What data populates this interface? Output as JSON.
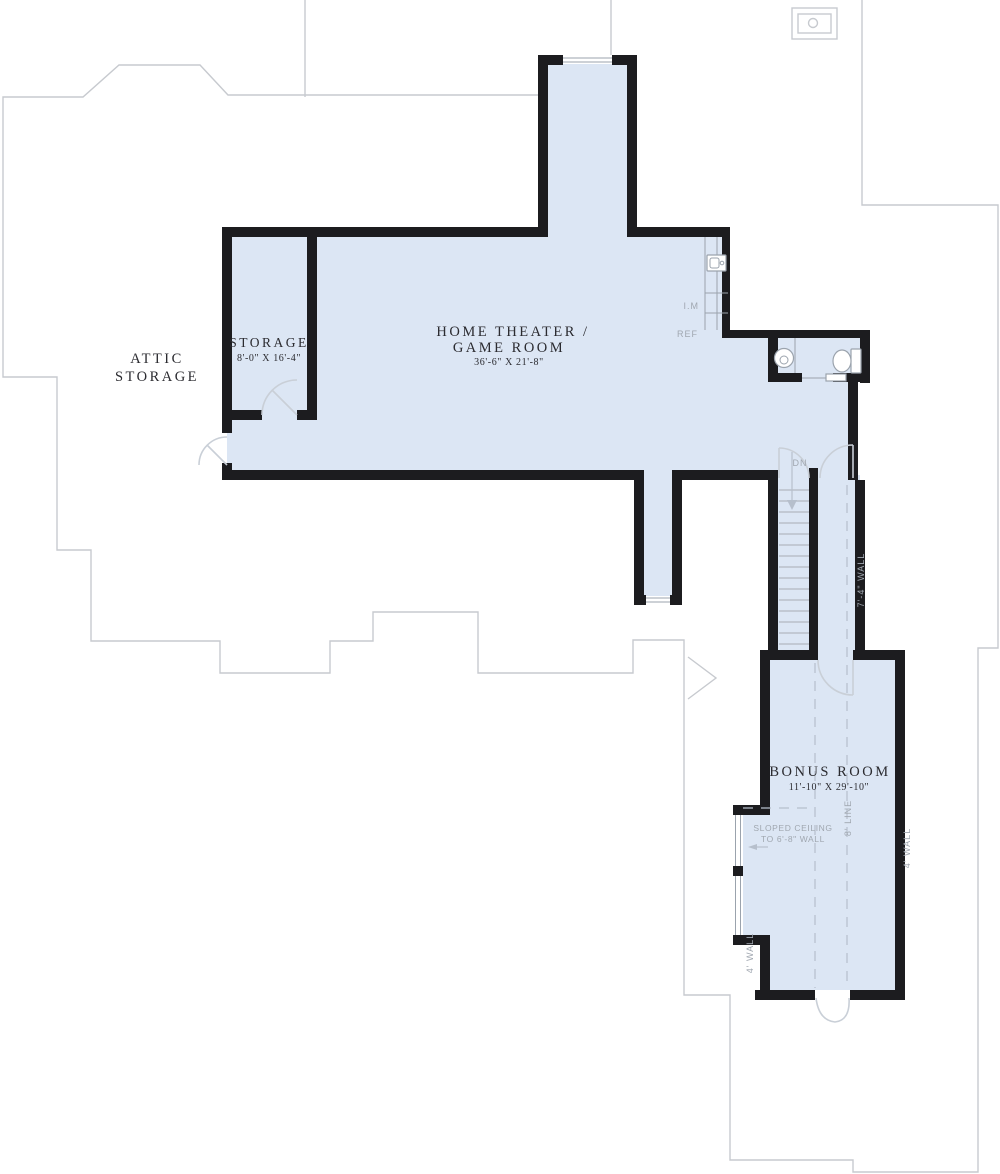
{
  "plan_type": "second-floor house plan",
  "colors": {
    "room_fill": "#dce6f4",
    "wall": "#1c1c1f",
    "roofline": "#c7cacf",
    "annotation": "#a0a7b0",
    "label": "#2b2b30"
  },
  "rooms": {
    "attic": {
      "line1": "ATTIC",
      "line2": "STORAGE"
    },
    "storage": {
      "name": "STORAGE",
      "dims": "8'-0\" X 16'-4\""
    },
    "theater": {
      "line1": "HOME THEATER /",
      "line2": "GAME ROOM",
      "dims": "36'-6\" X 21'-8\""
    },
    "bonus": {
      "name": "BONUS ROOM",
      "dims": "11'-10\" X 29'-10\""
    }
  },
  "annotations": {
    "down": "DN",
    "ice_maker": "I.M",
    "refrigerator": "REF",
    "sloped_line1": "SLOPED CEILING",
    "sloped_line2": "TO 6'-8\" WALL",
    "eight_line": "8' LINE",
    "wall_7_4": "7'-4\" WALL",
    "wall_4_left": "4' WALL",
    "wall_4_right": "4' WALL"
  }
}
